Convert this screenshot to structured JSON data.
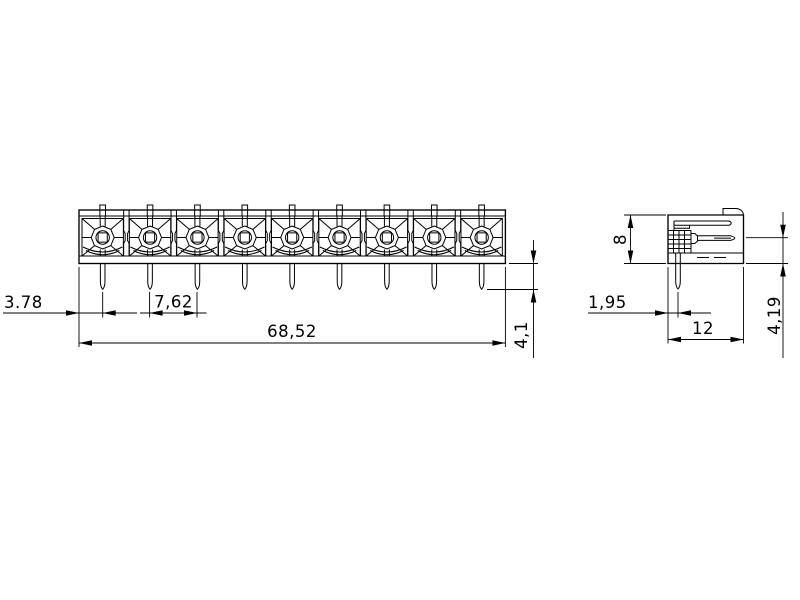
{
  "front_view": {
    "positions": 9,
    "dimensions": {
      "first_pin_offset": "3.78",
      "pin_pitch": "7,62",
      "overall_width": "68,52",
      "pin_protrusion": "4,1"
    }
  },
  "side_view": {
    "dimensions": {
      "body_height": "8",
      "pin_offset_from_face": "1,95",
      "body_depth": "12",
      "blade_axis_to_bottom": "4,19"
    }
  },
  "colors": {
    "background": "#ffffff",
    "line": "#000000",
    "text": "#000000"
  }
}
